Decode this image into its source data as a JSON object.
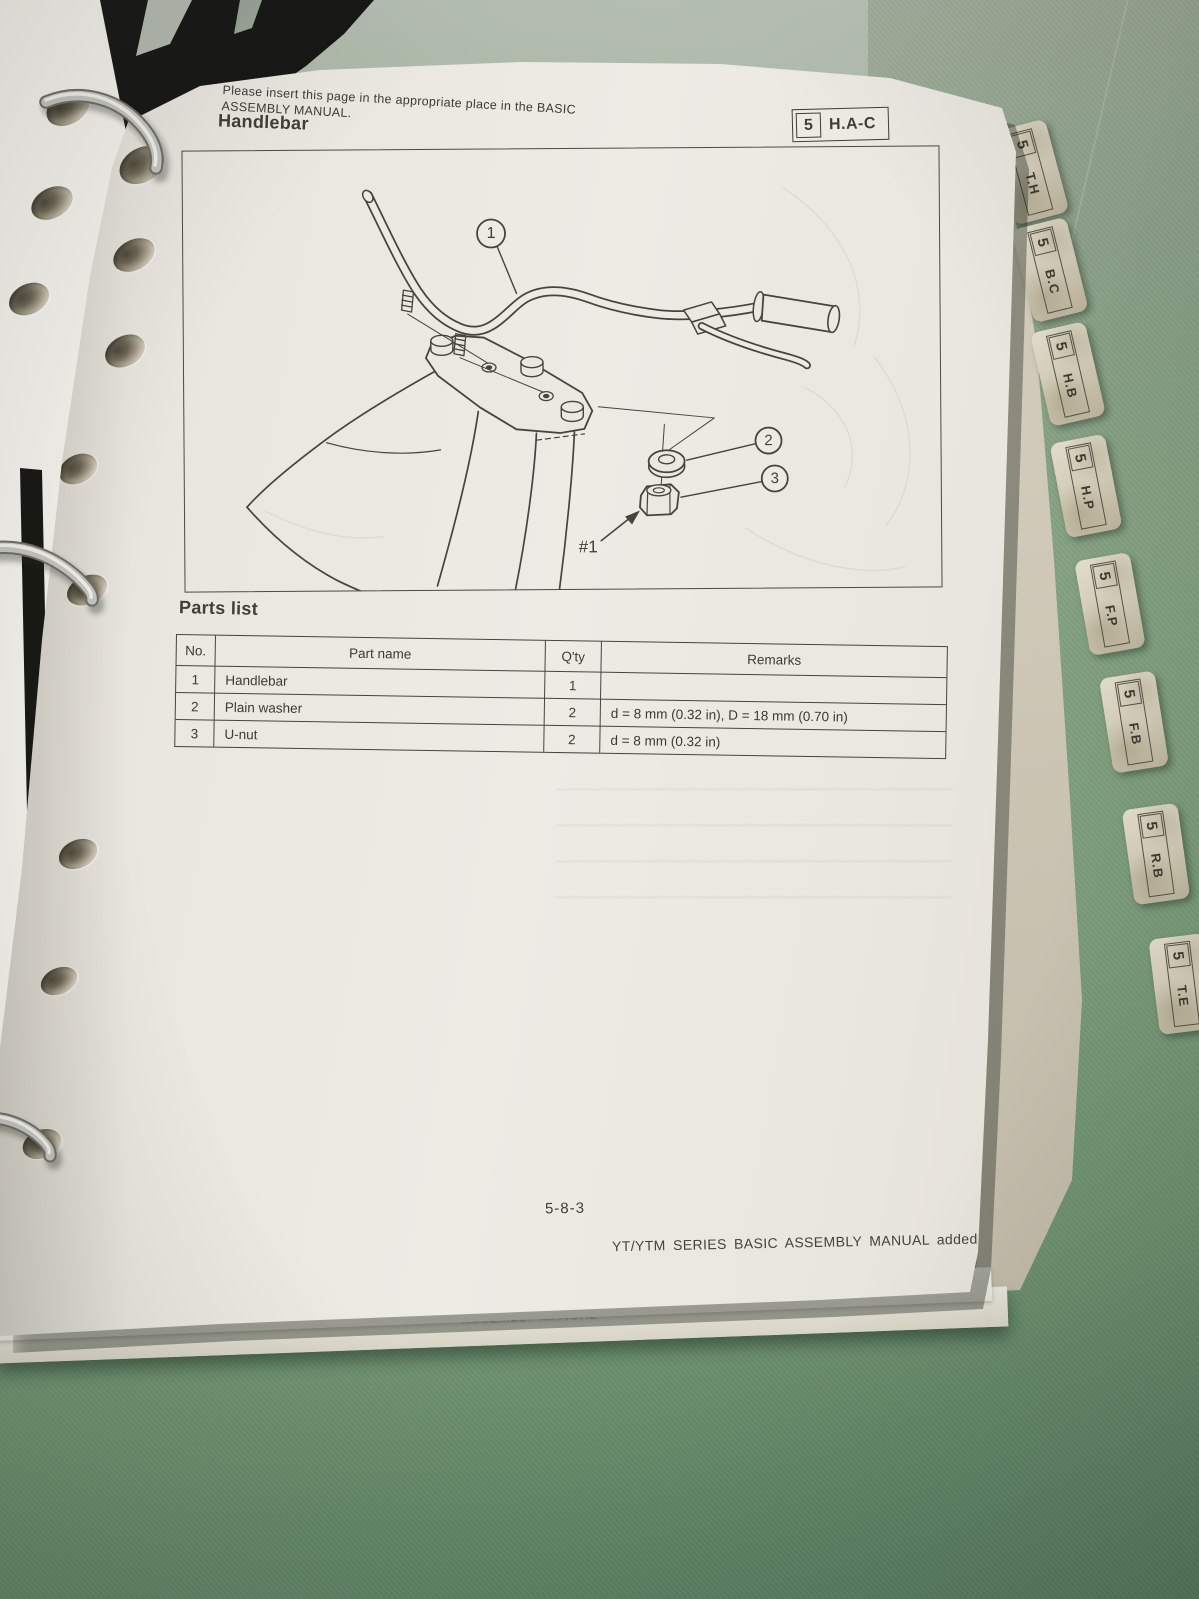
{
  "note": {
    "line1": "Please insert this page in the appropriate place in the BASIC",
    "line2": "ASSEMBLY MANUAL."
  },
  "header": {
    "title": "Handlebar",
    "badge_number": "5",
    "badge_code": "H.A-C"
  },
  "diagram": {
    "callout_1": "1",
    "callout_2": "2",
    "callout_3": "3",
    "ref_label": "#1"
  },
  "parts": {
    "title": "Parts list",
    "headers": [
      "No.",
      "Part name",
      "Q'ty",
      "Remarks"
    ],
    "rows": [
      {
        "no": "1",
        "part_name": "Handlebar",
        "qty": "1",
        "remarks": ""
      },
      {
        "no": "2",
        "part_name": "Plain washer",
        "qty": "2",
        "remarks": "d = 8 mm (0.32 in), D = 18 mm (0.70 in)"
      },
      {
        "no": "3",
        "part_name": "U-nut",
        "qty": "2",
        "remarks": "d = 8 mm (0.32 in)"
      }
    ]
  },
  "footer": {
    "page_number": "5-8-3",
    "imprint": "YT/YTM SERIES BASIC ASSEMBLY MANUAL added 5/83.",
    "ghost_text": "ASSEMBLY MANUAL"
  },
  "tabs": [
    {
      "number": "5",
      "label": "T.H"
    },
    {
      "number": "5",
      "label": "B.C"
    },
    {
      "number": "5",
      "label": "H.B"
    },
    {
      "number": "5",
      "label": "H.P"
    },
    {
      "number": "5",
      "label": "F.P"
    },
    {
      "number": "5",
      "label": "F.B"
    },
    {
      "number": "5",
      "label": "R.B"
    },
    {
      "number": "5",
      "label": "T.E"
    }
  ],
  "colors": {
    "fabric_green": "#7e9b7c",
    "paper": "#eae7e0",
    "ink": "#3f3e37",
    "binder_black": "#111110",
    "tab_paper": "#d6cfbc",
    "ring_silver": "#c4c3be",
    "line_art": "#45443d"
  }
}
